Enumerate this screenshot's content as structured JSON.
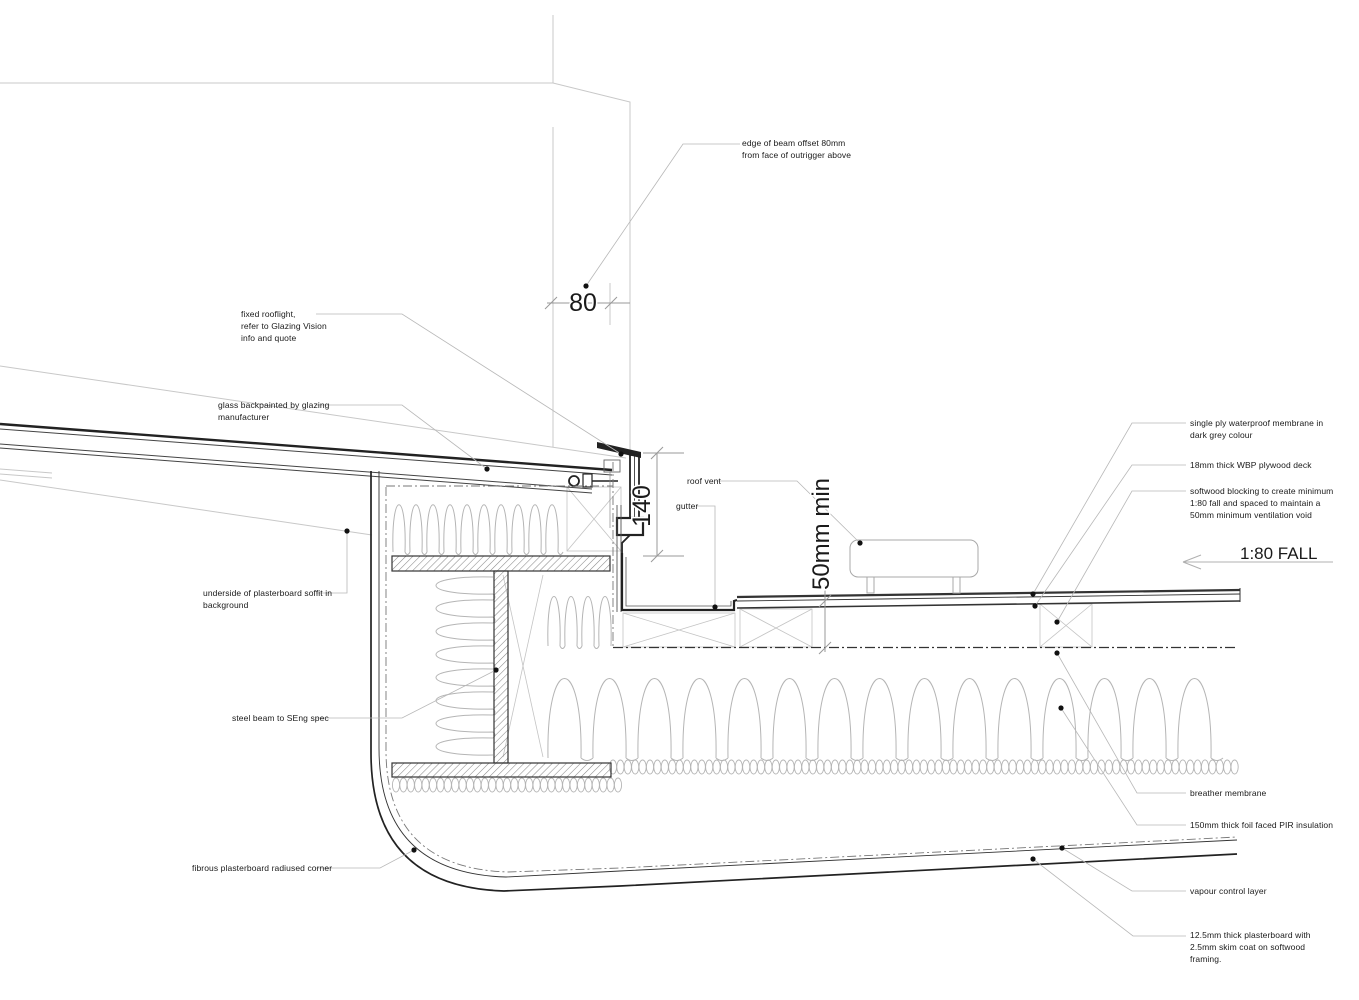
{
  "labels": {
    "edge_of_beam": [
      "edge of beam offset 80mm",
      "from face of outrigger above"
    ],
    "fixed_rooflight": [
      "fixed rooflight,",
      "refer to Glazing Vision",
      "info and quote"
    ],
    "glass_backpainted": [
      "glass backpainted by glazing",
      "manufacturer"
    ],
    "underside_soffit": [
      "underside of plasterboard soffit in",
      "background"
    ],
    "steel_beam": [
      "steel beam to SEng spec"
    ],
    "fibrous_plasterboard": [
      "fibrous plasterboard radiused corner"
    ],
    "single_ply": [
      "single ply waterproof membrane in",
      "dark grey colour"
    ],
    "plywood_deck": [
      "18mm thick WBP plywood deck"
    ],
    "softwood_blocking": [
      "softwood blocking to create minimum",
      "1:80 fall and spaced to maintain a",
      "50mm minimum ventilation void"
    ],
    "roof_vent": [
      "roof vent"
    ],
    "gutter": [
      "gutter"
    ],
    "breather_membrane": [
      "breather membrane"
    ],
    "pir_insulation": [
      "150mm thick foil faced PIR insulation"
    ],
    "vapour_control": [
      "vapour control layer"
    ],
    "plasterboard_ceiling": [
      "12.5mm thick plasterboard with",
      "2.5mm skim coat on softwood",
      "framing."
    ]
  },
  "dims": {
    "offset": "80",
    "upstand_height": "140",
    "vent_gap": "50mm min",
    "fall": "1:80 FALL"
  },
  "colors": {
    "paper": "#ffffff",
    "ink": "#1a1a1a",
    "dark": "#222222",
    "faint": "#c4c4c4",
    "leader": "#b8b8b8",
    "insulation": "#b5b5b5",
    "hatch": "#888888"
  }
}
